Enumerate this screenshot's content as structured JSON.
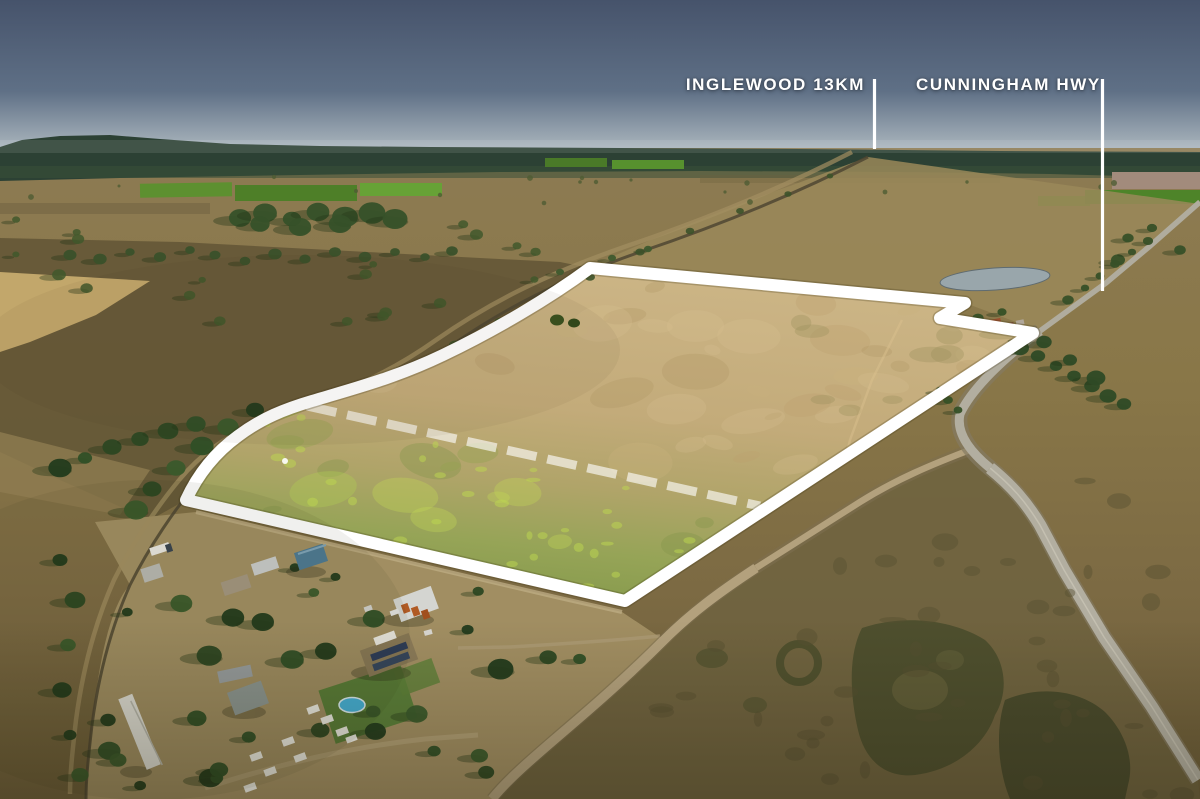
{
  "annotations": {
    "inglewood": {
      "label": "INGLEWOOD 13KM"
    },
    "cunningham": {
      "label": "CUNNINGHAM HWY"
    }
  },
  "colors": {
    "label_text": "#ffffff",
    "pointer_line": "#ffffff",
    "boundary": "#ffffff",
    "subdivision_dash": "#ffffff",
    "sky_top": "#46536b",
    "sky_mid": "#5f7086",
    "sky_horizon": "#aeb9c0",
    "forest_band": "#2c4134",
    "field_tan": "#8d7b53",
    "property_tan": "#ccb586",
    "property_green": "#84994b",
    "highway_surface": "#b2aea0",
    "side_road": "#b3a17d",
    "pond": "#9aa8b0"
  }
}
